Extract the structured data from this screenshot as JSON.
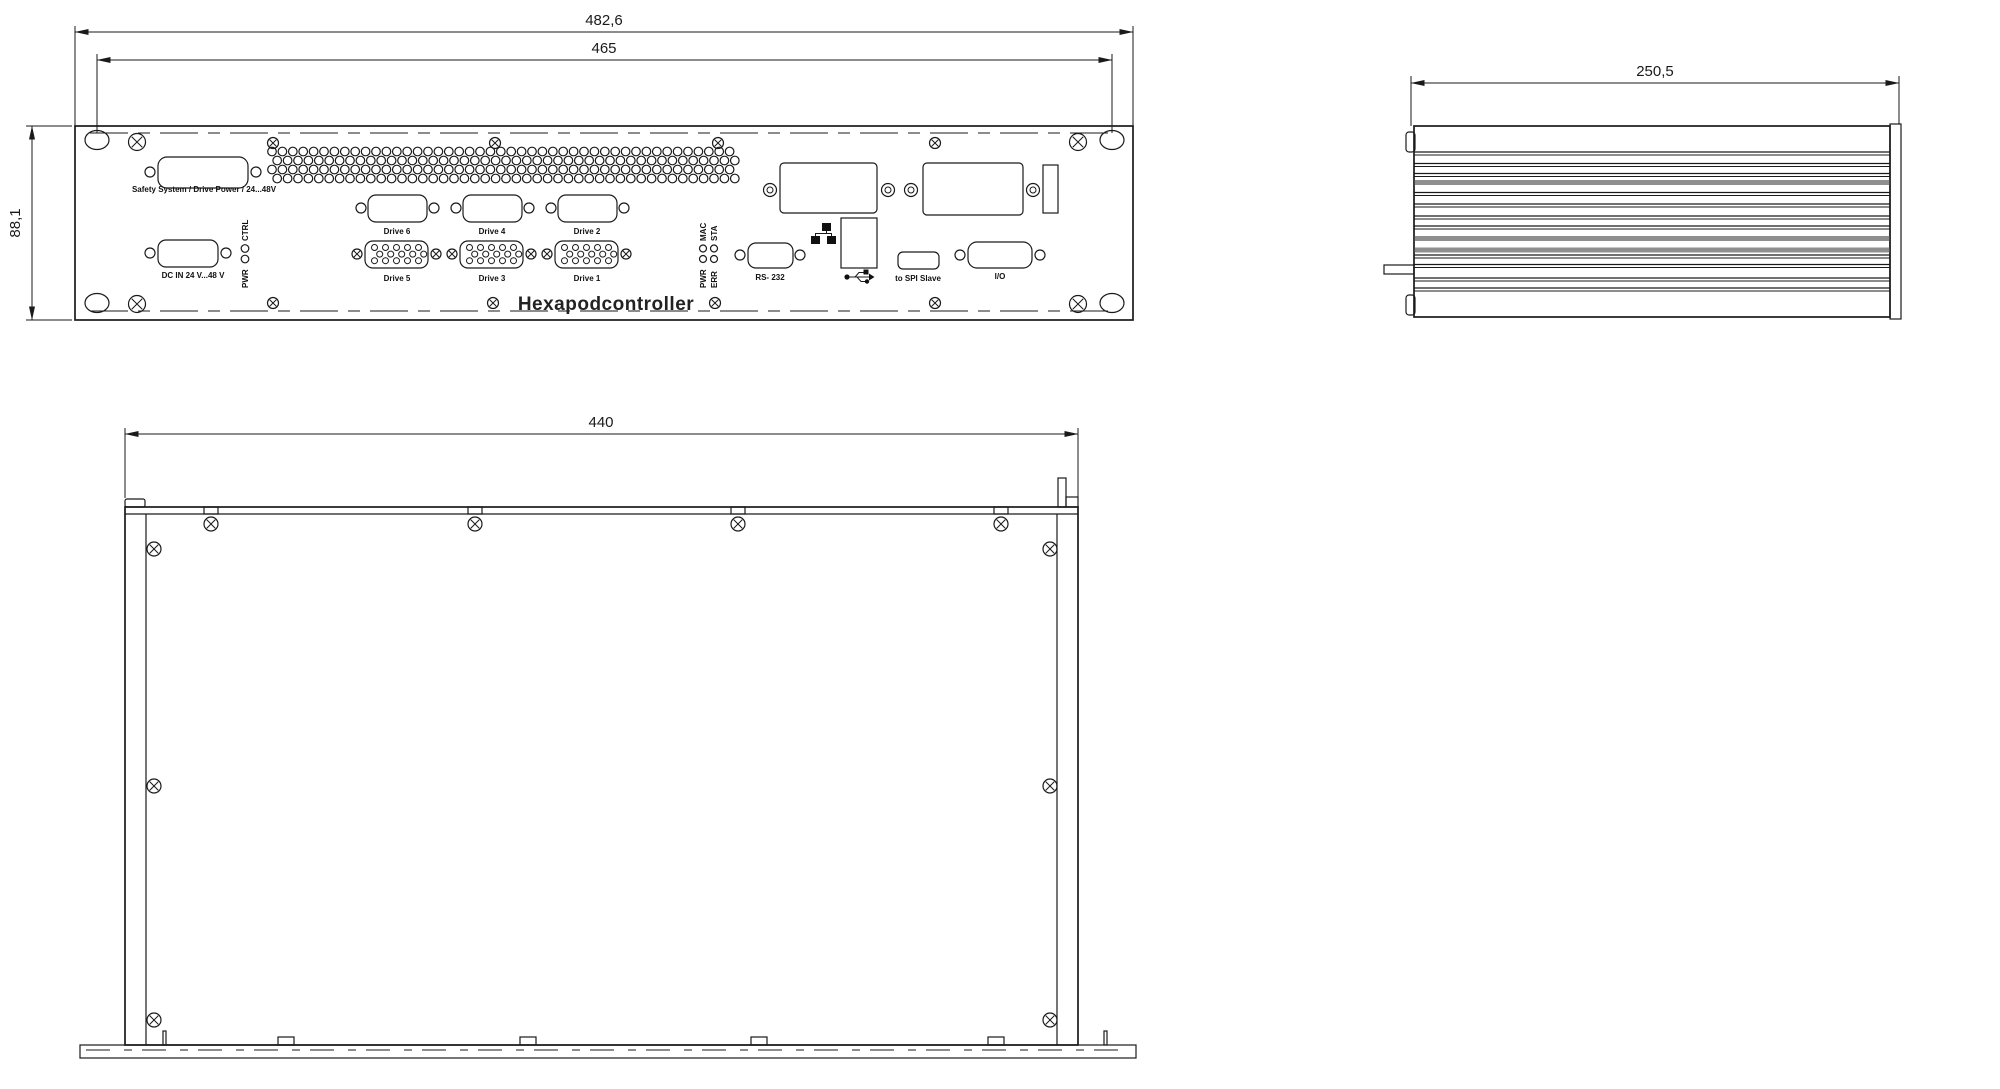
{
  "colors": {
    "background": "#ffffff",
    "line": "#1a1a1a",
    "fin_shadow": "#8f8f8f"
  },
  "front_view": {
    "dim_outer_width": "482,6",
    "dim_inner_width": "465",
    "dim_height": "88,1",
    "safety_label": "Safety System / Drive Power / 24...48V",
    "dc_in_label": "DC IN 24 V...48 V",
    "led_block_left": {
      "top_label": "CTRL",
      "bottom_label": "PWR"
    },
    "drives_top": [
      "Drive 6",
      "Drive 4",
      "Drive 2"
    ],
    "drives_bottom": [
      "Drive 5",
      "Drive 3",
      "Drive 1"
    ],
    "led_block_right": {
      "col1_top": "MAC",
      "col1_bottom": "PWR",
      "col2_top": "STA",
      "col2_bottom": "ERR"
    },
    "rs232_label": "RS- 232",
    "spi_label": "to SPI Slave",
    "io_label": "I/O",
    "product_name": "Hexapodcontroller",
    "icons": {
      "ethernet": "ethernet-icon",
      "usb": "usb-icon"
    }
  },
  "side_view": {
    "dim_width": "250,5"
  },
  "top_view": {
    "dim_width": "440"
  }
}
